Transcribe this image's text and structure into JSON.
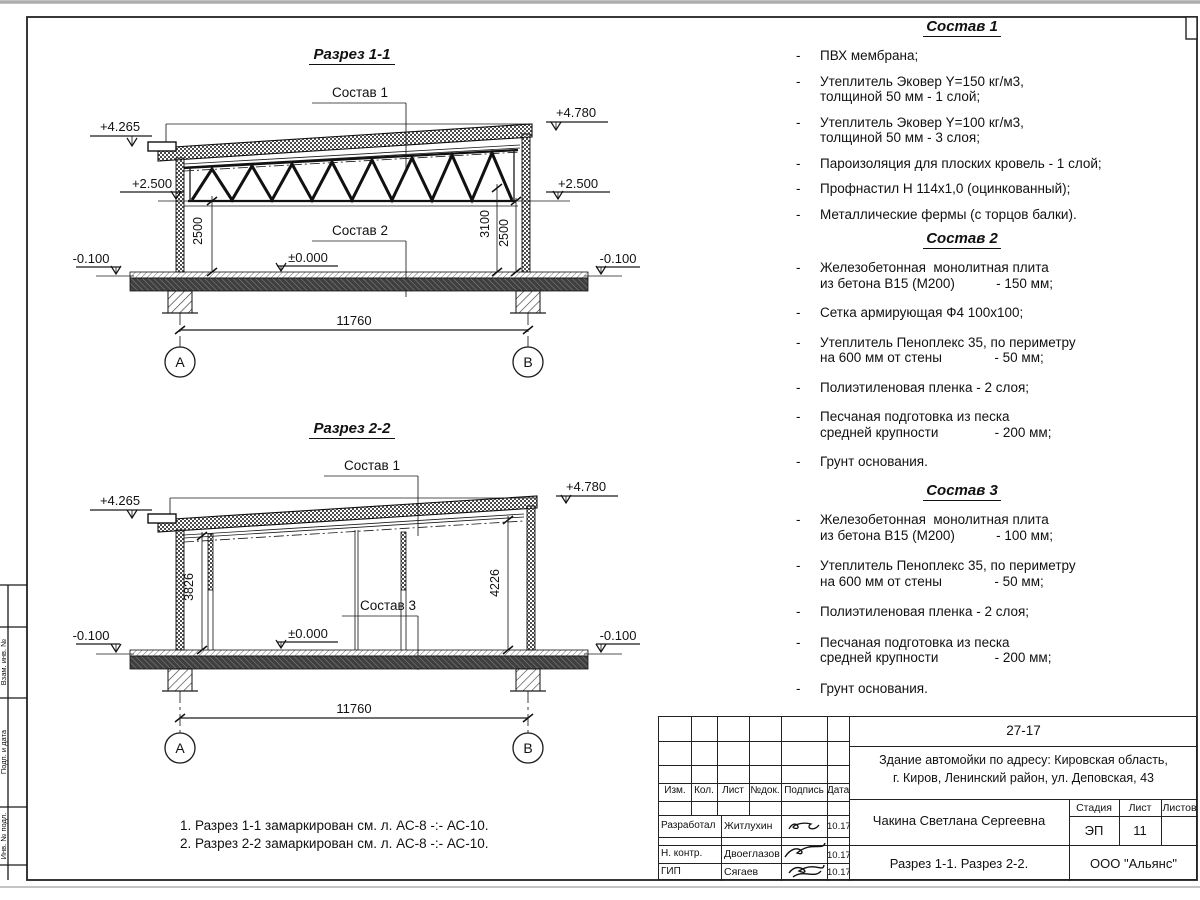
{
  "sections": {
    "s1": {
      "title": "Разрез 1-1",
      "callout_roof": "Состав 1",
      "callout_floor": "Состав 2",
      "level_top_left": "+4.265",
      "level_top_right": "+4.780",
      "level_mid_left": "+2.500",
      "level_mid_right": "+2.500",
      "level_zero": "±0.000",
      "level_ground_left": "-0.100",
      "level_ground_right": "-0.100",
      "dim_left": "2500",
      "dim_right_inner": "3100",
      "dim_right_outer": "2500",
      "dim_span": "11760",
      "axis_a": "А",
      "axis_b": "В"
    },
    "s2": {
      "title": "Разрез 2-2",
      "callout_roof": "Состав 1",
      "callout_floor": "Состав 3",
      "level_top_left": "+4.265",
      "level_top_right": "+4.780",
      "level_zero": "±0.000",
      "level_ground_left": "-0.100",
      "level_ground_right": "-0.100",
      "dim_left": "3826",
      "dim_right": "4226",
      "dim_span": "11760",
      "axis_a": "А",
      "axis_b": "В"
    }
  },
  "sostav1": {
    "title": "Состав 1",
    "items": [
      {
        "dash": "-",
        "lines": [
          "ПВХ мембрана;"
        ]
      },
      {
        "dash": "-",
        "lines": [
          "Утеплитель Эковер Y=150 кг/м3,",
          "толщиной 50 мм - 1 слой;"
        ]
      },
      {
        "dash": "-",
        "lines": [
          "Утеплитель Эковер Y=100 кг/м3,",
          "толщиной 50 мм - 3 слоя;"
        ]
      },
      {
        "dash": "-",
        "lines": [
          "Пароизоляция для плоских кровель - 1 слой;"
        ]
      },
      {
        "dash": "-",
        "lines": [
          "Профнастил Н 114х1,0 (оцинкованный);"
        ]
      },
      {
        "dash": "-",
        "lines": [
          "Металлические фермы (с торцов балки)."
        ]
      }
    ]
  },
  "sostav2": {
    "title": "Состав 2",
    "items": [
      {
        "dash": "-",
        "lines": [
          "Железобетонная  монолитная плита",
          "из бетона В15 (М200)           - 150 мм;"
        ]
      },
      {
        "dash": "-",
        "lines": [
          "Сетка армирующая Ф4 100х100;"
        ]
      },
      {
        "dash": "-",
        "lines": [
          "Утеплитель Пеноплекс 35, по периметру",
          "на 600 мм от стены              - 50 мм;"
        ]
      },
      {
        "dash": "-",
        "lines": [
          "Полиэтиленовая пленка - 2 слоя;"
        ]
      },
      {
        "dash": "-",
        "lines": [
          "Песчаная подготовка из песка",
          "средней крупности               - 200 мм;"
        ]
      },
      {
        "dash": "-",
        "lines": [
          "Грунт основания."
        ]
      }
    ]
  },
  "sostav3": {
    "title": "Состав 3",
    "items": [
      {
        "dash": "-",
        "lines": [
          "Железобетонная  монолитная плита",
          "из бетона В15 (М200)           - 100 мм;"
        ]
      },
      {
        "dash": "-",
        "lines": [
          "Утеплитель Пеноплекс 35, по периметру",
          "на 600 мм от стены              - 50 мм;"
        ]
      },
      {
        "dash": "-",
        "lines": [
          "Полиэтиленовая пленка - 2 слоя;"
        ]
      },
      {
        "dash": "-",
        "lines": [
          "Песчаная подготовка из песка",
          "средней крупности               - 200 мм;"
        ]
      },
      {
        "dash": "-",
        "lines": [
          "Грунт основания."
        ]
      }
    ]
  },
  "notes": {
    "line1": "1. Разрез 1-1 замаркирован см. л. АС-8 -:- АС-10.",
    "line2": "2. Разрез 2-2 замаркирован см. л. АС-8 -:- АС-10."
  },
  "titleblock": {
    "code": "27-17",
    "object_line1": "Здание автомойки по адресу: Кировская область,",
    "object_line2": "г. Киров, Ленинский район, ул. Деповская, 43",
    "author": "Чакина Светлана Сергеевна",
    "sheet_name": "Разрез 1-1. Разрез 2-2.",
    "org": "ООО \"Альянс\"",
    "stage_label": "Стадия",
    "sheet_label": "Лист",
    "sheets_label": "Листов",
    "stage": "ЭП",
    "sheet": "11",
    "sheets": "",
    "cols": {
      "izm": "Изм.",
      "kol": "Кол.",
      "list": "Лист",
      "ndoc": "№док.",
      "podpis": "Подпись",
      "data": "Дата"
    },
    "rows": [
      {
        "role": "Разработал",
        "name": "Житлухин",
        "date": "10.17"
      },
      {
        "role": "Н. контр.",
        "name": "Двоеглазов",
        "date": "10.17"
      },
      {
        "role": "ГИП",
        "name": "Сягаев",
        "date": "10.17"
      }
    ]
  },
  "side_strip": {
    "label1": "Взам. инв. №",
    "label2": "Подп. и дата",
    "label3": "Инв. № подл."
  }
}
